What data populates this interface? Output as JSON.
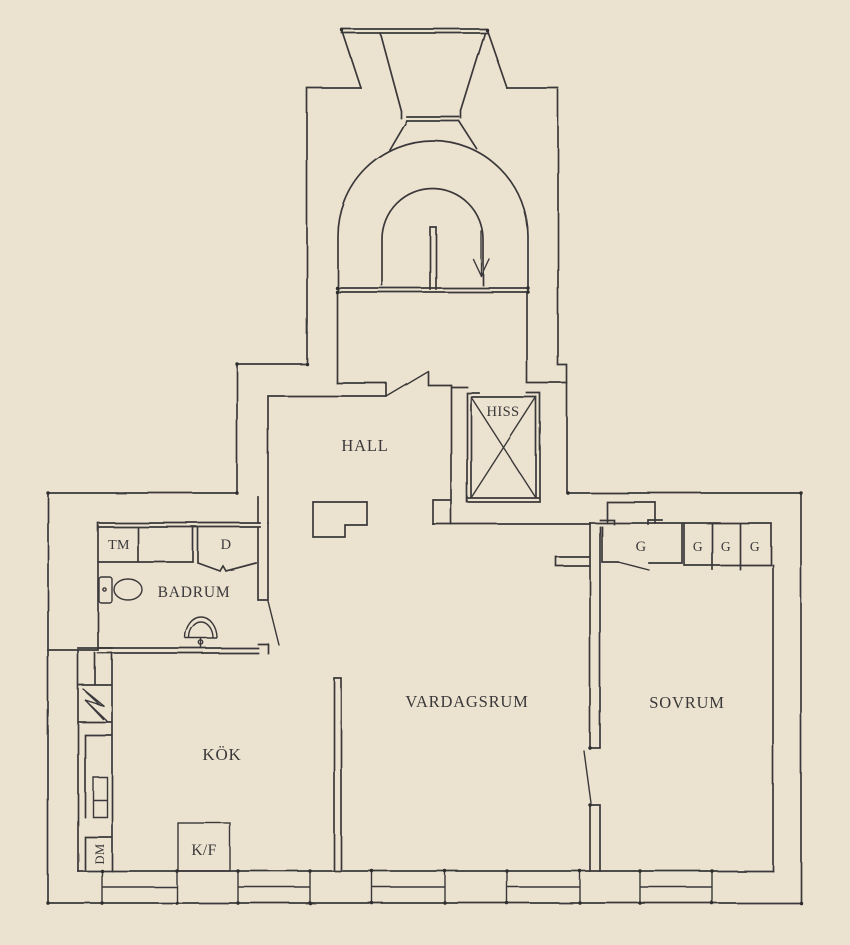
{
  "meta": {
    "type": "apartment-floor-plan",
    "style": "hand-drawn sketch",
    "background_color": "#EBE2CF",
    "line_color": "#3A383A"
  },
  "rooms": {
    "hall": "HALL",
    "elevator": "HISS",
    "bathroom": "BADRUM",
    "kitchen": "KÖK",
    "living_room": "VARDAGSRUM",
    "bedroom": "SOVRUM"
  },
  "fixtures": {
    "washing_machine": "TM",
    "shower_cabinet": "D",
    "fridge_freezer": "K/F",
    "dishwasher": "DM",
    "wardrobes": [
      "G",
      "G",
      "G",
      "G"
    ]
  }
}
